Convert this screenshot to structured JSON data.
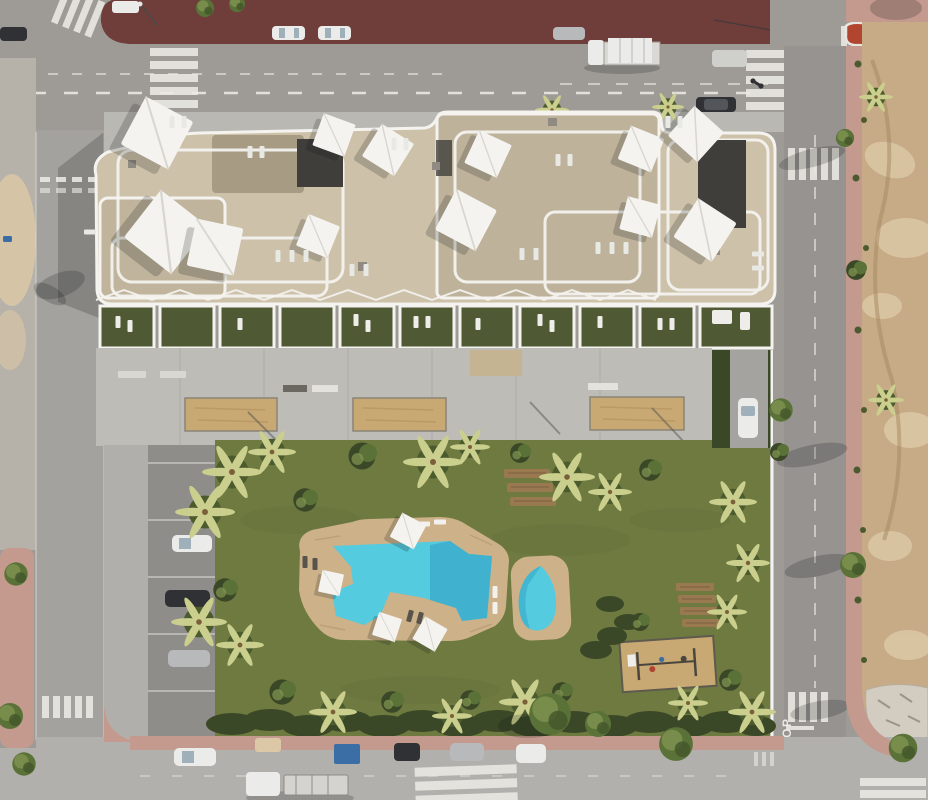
{
  "meta": {
    "title": "Aerial drone render of a residential apartment complex with communal pool",
    "style": "top-down 3D architectural visualization"
  },
  "palette": {
    "road": "#9e9b96",
    "road_right": "#969390",
    "road_bottom": "#b2b0ac",
    "road_left": "#a4a29e",
    "promenade_maroon": "#6f3d3a",
    "island_red": "#b2452f",
    "sidewalk_pink": "#c49a8e",
    "sidewalk_gray": "#b6b1a9",
    "sidewalk_light": "#bab8b3",
    "marking_white": "#eceae4",
    "dirt": "#c7ab87",
    "dirt_light": "#dcc8a6",
    "rubble": "#d3ccc0",
    "plaza_concrete": "#bebcb6",
    "parking_light": "#b1afab",
    "parking_dark": "#8f8d89",
    "building_beige": "#cdc1a9",
    "building_gravel": "#beb29a",
    "gravel_dark": "#a89b84",
    "parapet_white": "#f4f3ef",
    "roof_dark": "#403e3b",
    "terrace_grass": "#4f5a34",
    "lawn": "#6e7a40",
    "hedge": "#3a4827",
    "palm_light": "#cbcf8d",
    "palm_dark": "#4b5b2e",
    "tree_green": "#5a7238",
    "tree_light": "#839753",
    "pool_deck": "#ccb189",
    "pool_water": "#55cbdf",
    "pool_water_deep": "#2f9dc0",
    "sand": "#c8a873",
    "wood": "#99794f",
    "car_white": "#ebebe9",
    "car_dark": "#303134",
    "car_silver": "#b8b9bb",
    "car_blue": "#3a6ea5",
    "entry_mat": "#c5b491",
    "shadow": "rgba(15,18,22,0.20)"
  },
  "scene": {
    "building": {
      "label": "apartment block with rooftop terraces",
      "roof": "beige pavers and gravel with white parapet walls",
      "shade_sails": 11,
      "ground_floor_terraces": 11
    },
    "amenities": {
      "main_pool": "freeform turquoise swimming pool",
      "secondary_pool": "teardrop plunge pool",
      "playground": "sand play area with equipment",
      "sand_courts": 3,
      "wood_sunbed_groups": 2
    },
    "garden": "communal lawn with palm trees, bushes and perimeter hedge",
    "parking": {
      "label": "open-air parking strip",
      "parked_cars": 3
    },
    "roads": {
      "stop_marking": "STOP",
      "crosswalks": 8,
      "north_road_vehicles": [
        "sedan",
        "sedan",
        "sedan",
        "flatbed truck",
        "van",
        "motorbike",
        "suv",
        "turning car"
      ],
      "south_street_vehicles": [
        "white car",
        "cart",
        "blue container",
        "dark van",
        "silver car",
        "white car",
        "car under tree",
        "truck with trailer"
      ]
    },
    "surroundings": {
      "north": "dark red paved promenade",
      "east": "undeveloped dirt plot with rubble",
      "west": "side street with sidewalk and trees"
    }
  }
}
